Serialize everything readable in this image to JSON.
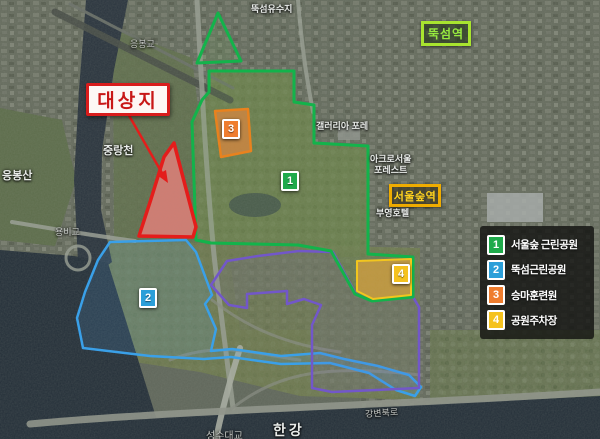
{
  "annotations": {
    "target_site_label": "대상지",
    "stations": {
      "ttukseom": "뚝섬역",
      "seoul_forest": "서울숲역"
    }
  },
  "legend": {
    "items": [
      {
        "number": "1",
        "label": "서울숲 근린공원",
        "color": "#1faa4b"
      },
      {
        "number": "2",
        "label": "뚝섬근린공원",
        "color": "#2b9fd9"
      },
      {
        "number": "3",
        "label": "승마훈련원",
        "color": "#ef7d2e"
      },
      {
        "number": "4",
        "label": "공원주차장",
        "color": "#f5c21e"
      }
    ]
  },
  "map_labels": {
    "ttukseom_reservoir": "뚝섬유수지",
    "eungbonggyo_bridge": "응봉교",
    "jungnangcheon_stream": "중랑천",
    "eungbongsan_mountain": "응봉산",
    "yongbigyo_bridge": "용비교",
    "galleria_foret": "갤러리아 포레",
    "acro_seoul_line1": "아크로서울",
    "acro_seoul_line2": "포레스트",
    "booyoung_hotel": "부영호텔",
    "seongsu_bridge": "성수대교",
    "han_river": "한강",
    "gangbyeon_expressway": "강변북로"
  },
  "colors": {
    "park_outline_green": "#13b34b",
    "target_outline_red": "#e41d1b",
    "ttukseom_park_blue": "#3aa0e8",
    "riverside_purple": "#7257c9",
    "riding_center_orange": "#e8821e",
    "parking_yellow": "#f2c61e"
  }
}
